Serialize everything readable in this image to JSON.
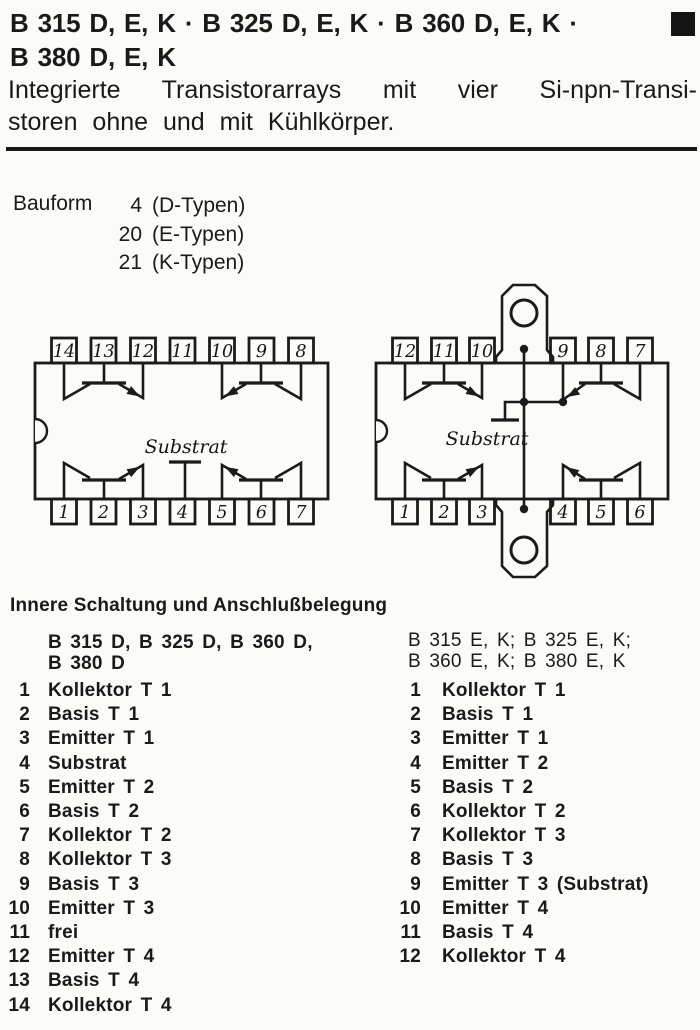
{
  "header": {
    "title_line1": "B 315 D, E, K · B 325 D, E, K · B 360 D, E, K ·",
    "title_line2": "B 380 D, E, K",
    "subtitle_line1": "Integrierte Transistorarrays mit vier Si-npn-Transi-",
    "subtitle_line2": "storen ohne und mit Kühlkörper.",
    "corner_marker_icon": "black-square"
  },
  "bauform": {
    "label": "Bauform",
    "rows": [
      {
        "num": "4",
        "text": "(D-Typen)"
      },
      {
        "num": "20",
        "text": "(E-Typen)"
      },
      {
        "num": "21",
        "text": "(K-Typen)"
      }
    ]
  },
  "diagrams": {
    "substrat_label": "Substrat",
    "d": {
      "pins_top": [
        "14",
        "13",
        "12",
        "11",
        "10",
        "9",
        "8"
      ],
      "pins_bottom": [
        "1",
        "2",
        "3",
        "4",
        "5",
        "6",
        "7"
      ]
    },
    "ek": {
      "pins_top": [
        "12",
        "11",
        "10",
        "9",
        "8",
        "7"
      ],
      "pins_bottom": [
        "1",
        "2",
        "3",
        "4",
        "5",
        "6"
      ]
    }
  },
  "pinout": {
    "heading": "Innere Schaltung und Anschlußbelegung",
    "left": {
      "header_line1": "B 315 D, B 325 D, B 360 D,",
      "header_line2": "B 380 D",
      "pins": [
        {
          "n": "1",
          "label": "Kollektor T 1"
        },
        {
          "n": "2",
          "label": "Basis T 1"
        },
        {
          "n": "3",
          "label": "Emitter T 1"
        },
        {
          "n": "4",
          "label": "Substrat"
        },
        {
          "n": "5",
          "label": "Emitter T 2"
        },
        {
          "n": "6",
          "label": "Basis T 2"
        },
        {
          "n": "7",
          "label": "Kollektor T 2"
        },
        {
          "n": "8",
          "label": "Kollektor T 3"
        },
        {
          "n": "9",
          "label": "Basis T 3"
        },
        {
          "n": "10",
          "label": "Emitter T 3"
        },
        {
          "n": "11",
          "label": "frei"
        },
        {
          "n": "12",
          "label": "Emitter T 4"
        },
        {
          "n": "13",
          "label": "Basis T 4"
        },
        {
          "n": "14",
          "label": "Kollektor T 4"
        }
      ]
    },
    "right": {
      "header_line1": "B 315 E, K; B 325 E, K;",
      "header_line2": "B 360 E, K; B 380 E, K",
      "pins": [
        {
          "n": "1",
          "label": "Kollektor T 1"
        },
        {
          "n": "2",
          "label": "Basis T 1"
        },
        {
          "n": "3",
          "label": "Emitter T 1"
        },
        {
          "n": "4",
          "label": "Emitter T 2"
        },
        {
          "n": "5",
          "label": "Basis T 2"
        },
        {
          "n": "6",
          "label": "Kollektor T 2"
        },
        {
          "n": "7",
          "label": "Kollektor T 3"
        },
        {
          "n": "8",
          "label": "Basis T 3"
        },
        {
          "n": "9",
          "label": "Emitter T 3 (Substrat)"
        },
        {
          "n": "10",
          "label": "Emitter T 4"
        },
        {
          "n": "11",
          "label": "Basis T 4"
        },
        {
          "n": "12",
          "label": "Kollektor T 4"
        }
      ]
    }
  }
}
